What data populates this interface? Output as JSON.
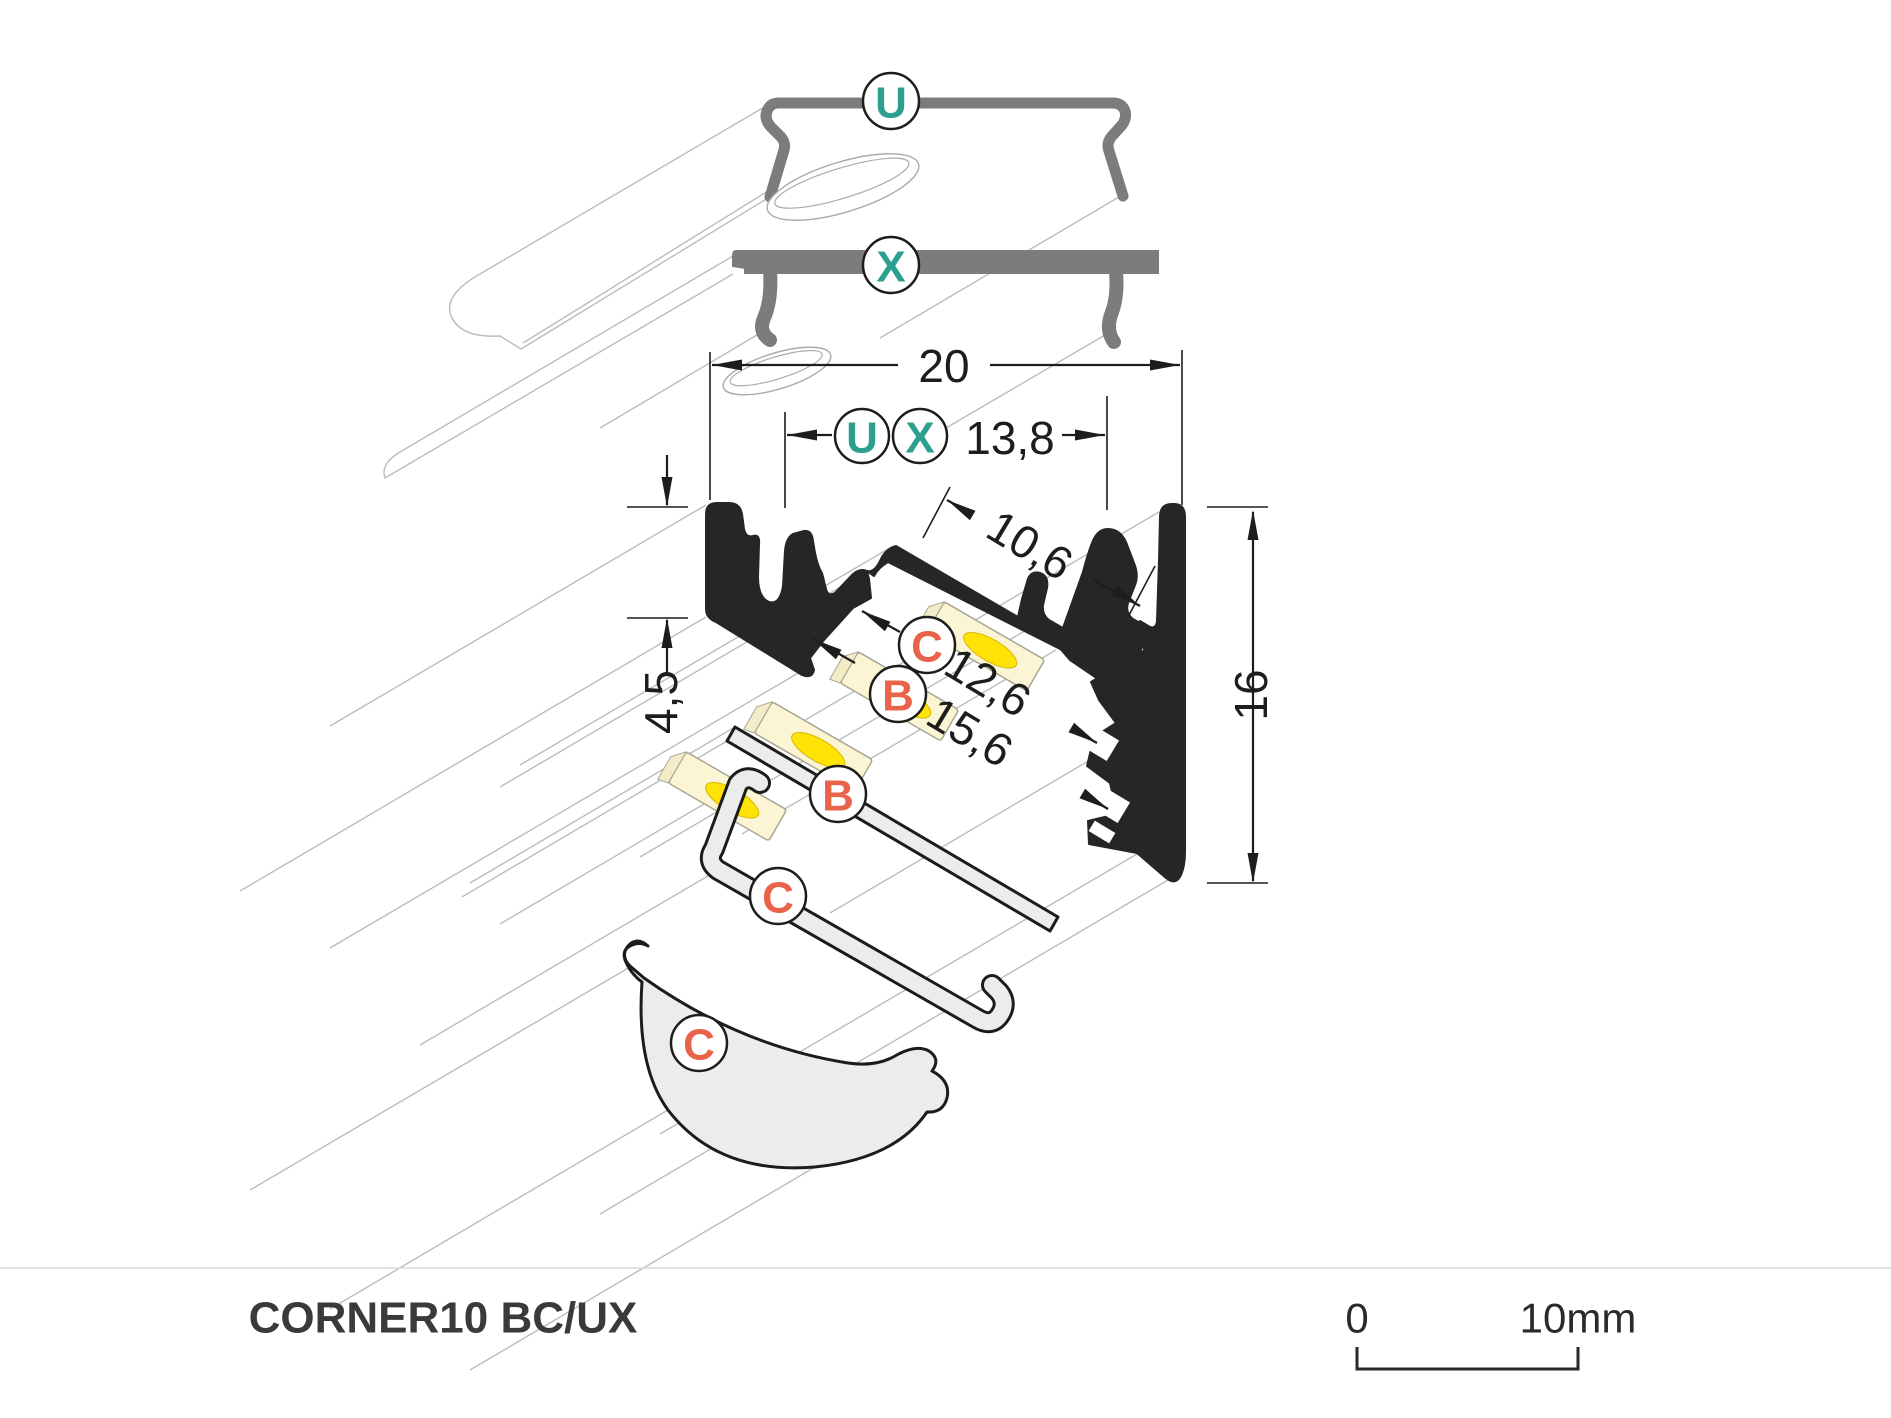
{
  "diagram": {
    "title": "CORNER10 BC/UX",
    "scale": {
      "start": "0",
      "end": "10mm"
    },
    "dimensions": {
      "total_width": "20",
      "inner_width": "13,8",
      "opening": "10,6",
      "groove_b": "12,6",
      "groove_c": "15,6",
      "offset": "4,5",
      "height": "16"
    },
    "callouts": {
      "bracket_top": "U",
      "plate_top": "X",
      "bracket_dim": "U",
      "plate_dim": "X",
      "cover_c_dim": "C",
      "cover_b_dim": "B",
      "cover_b": "B",
      "cover_c": "C",
      "diffuser_c": "C"
    },
    "colors": {
      "accent_teal": "#2ca08e",
      "accent_orange": "#e8634a",
      "profile_black": "#262624",
      "hardware_gray": "#7c7c7c"
    }
  }
}
